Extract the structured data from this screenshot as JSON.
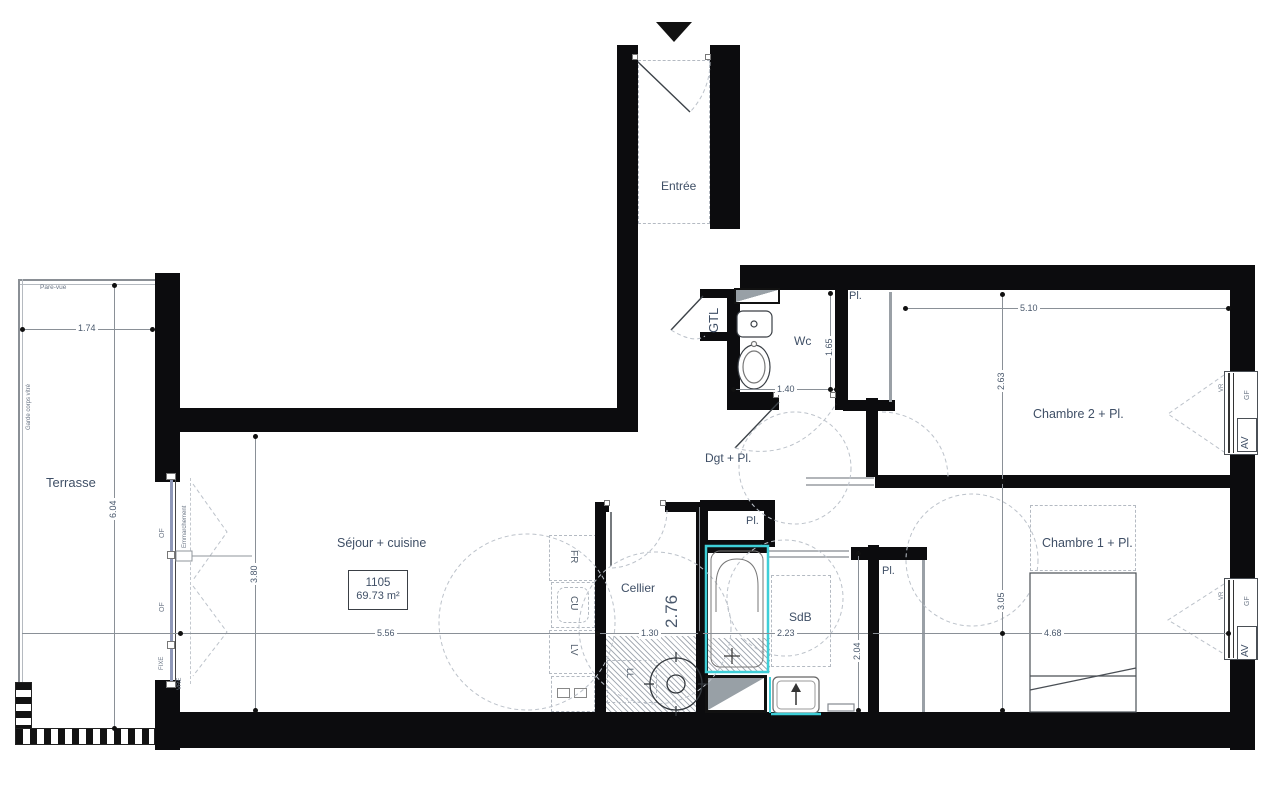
{
  "lot": {
    "number": "1105",
    "area": "69.73 m²"
  },
  "rooms": {
    "entree": "Entrée",
    "terrasse": "Terrasse",
    "sejour": "Séjour + cuisine",
    "cellier": "Cellier",
    "wc": "Wc",
    "sdb": "SdB",
    "dgt": "Dgt + Pl.",
    "chambre1": "Chambre 1 + Pl.",
    "chambre2": "Chambre 2 + Pl.",
    "gtl": "GTL",
    "placard": "Pl."
  },
  "dims": {
    "terrasse_width": "1.74",
    "terrasse_depth": "6.04",
    "sejour_depth": "3.80",
    "sejour_width": "5.56",
    "cellier_width": "1.30",
    "cellier_depth": "2.76",
    "sdb_width": "2.23",
    "sdb_depth": "2.04",
    "wc_width": "1.40",
    "wc_depth": "1.65",
    "chambre1_width": "4.68",
    "chambre1_depth": "3.05",
    "chambre2_width": "5.10",
    "chambre2_depth": "2.63"
  },
  "openings": {
    "av": "AV",
    "gf": "GF",
    "vr": "VR",
    "of": "OF",
    "fixe": "FIXE",
    "vre": "VRE"
  },
  "terrace_features": {
    "pare_vue": "Pare-vue",
    "garde_corps": "Garde corps vitré",
    "emmarchement": "Emmarchement"
  },
  "kitchen": {
    "fridge": "FR",
    "cooktop": "CU",
    "dishwasher": "LV",
    "washer": "LL"
  },
  "colors": {
    "wall": "#0c0c0e",
    "text": "#3f4f66",
    "dimension": "#49586c",
    "cyan_accent": "#3ecfd8",
    "shaft_gray": "#98a0a6"
  }
}
